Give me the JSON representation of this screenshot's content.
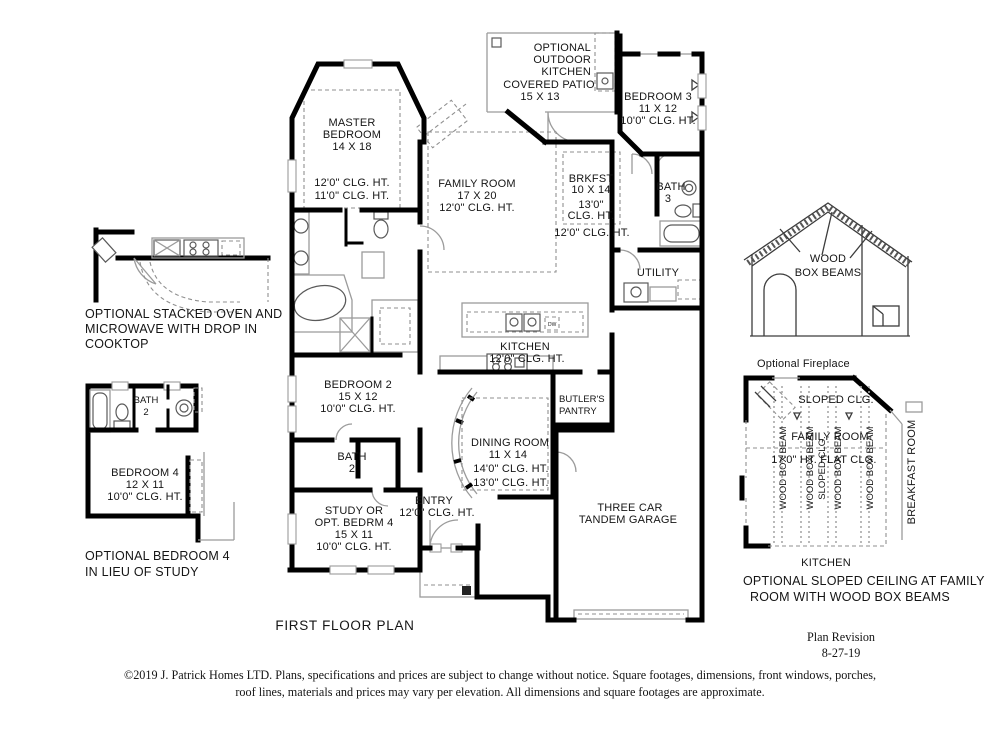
{
  "palette": {
    "wall": "#000000",
    "thin_line": "#9b9b9b",
    "dash_line": "#8f8f8f",
    "text": "#151515",
    "background": "#ffffff"
  },
  "main_plan": {
    "optional_outdoor_kitchen": [
      "OPTIONAL",
      "OUTDOOR",
      "KITCHEN"
    ],
    "covered_patio": [
      "COVERED PATIO",
      "15 X 13"
    ],
    "master_bedroom": [
      "MASTER",
      "BEDROOM",
      "14 X 18"
    ],
    "master_clg": [
      "12'0\" CLG. HT.",
      "11'0\" CLG. HT."
    ],
    "family_room": [
      "FAMILY ROOM",
      "17 X 20",
      "12'0\" CLG. HT."
    ],
    "brkfst": [
      "BRKFST",
      "10 X 14",
      "13'0\"",
      "CLG. HT."
    ],
    "brkfst_outer_clg": "12'0\" CLG. HT.",
    "bedroom3": [
      "BEDROOM 3",
      "11 X 12",
      "10'0\" CLG. HT."
    ],
    "bath3": [
      "BATH",
      "3"
    ],
    "utility": "UTILITY",
    "kitchen": [
      "KITCHEN",
      "12'0\" CLG. HT."
    ],
    "dw": "DW",
    "butlers_pantry": [
      "BUTLER'S",
      "PANTRY"
    ],
    "dining_room": [
      "DINING ROOM",
      "11 X 14",
      "14'0\" CLG. HT.",
      "13'0\" CLG. HT."
    ],
    "entry": [
      "ENTRY",
      "12'0\" CLG. HT."
    ],
    "bedroom2": [
      "BEDROOM 2",
      "15 X 12",
      "10'0\" CLG. HT."
    ],
    "bath2": [
      "BATH",
      "2"
    ],
    "study": [
      "STUDY OR",
      "OPT. BEDRM 4",
      "15 X 11",
      "10'0\" CLG. HT."
    ],
    "garage": [
      "THREE CAR",
      "TANDEM GARAGE"
    ]
  },
  "left_details": {
    "oven_caption": [
      "OPTIONAL STACKED OVEN AND",
      "MICROWAVE WITH DROP IN",
      "COOKTOP"
    ],
    "bath2": [
      "BATH",
      "2"
    ],
    "bedroom4": [
      "BEDROOM 4",
      "12 X 11",
      "10'0\" CLG. HT."
    ],
    "bedroom4_caption": [
      "OPTIONAL BEDROOM 4",
      "IN LIEU OF STUDY"
    ]
  },
  "right_details": {
    "wood_box_beams": [
      "WOOD",
      "BOX BEAMS"
    ],
    "optional_fireplace": "Optional Fireplace",
    "sloped_clg": "SLOPED CLG.",
    "family_room": "FAMILY ROOM",
    "flat_clg": "17'0\" HT.   FLAT CLG.",
    "beam_label": "WOOD BOX BEAM",
    "sloped_clg_vertical": "SLOPED CLG.",
    "breakfast_room": "BREAKFAST ROOM",
    "kitchen": "KITCHEN",
    "sloped_caption": [
      "OPTIONAL SLOPED CEILING AT FAMILY",
      "ROOM WITH WOOD BOX BEAMS"
    ]
  },
  "footer": {
    "title": "FIRST FLOOR PLAN",
    "revision": [
      "Plan Revision",
      "8-27-19"
    ],
    "copyright": [
      "©2019 J. Patrick Homes LTD.  Plans, specifications and prices are subject to change without notice.  Square footages, dimensions, front windows, porches,",
      "roof lines, materials and prices may vary per elevation.   All dimensions and square footages are approximate."
    ]
  }
}
